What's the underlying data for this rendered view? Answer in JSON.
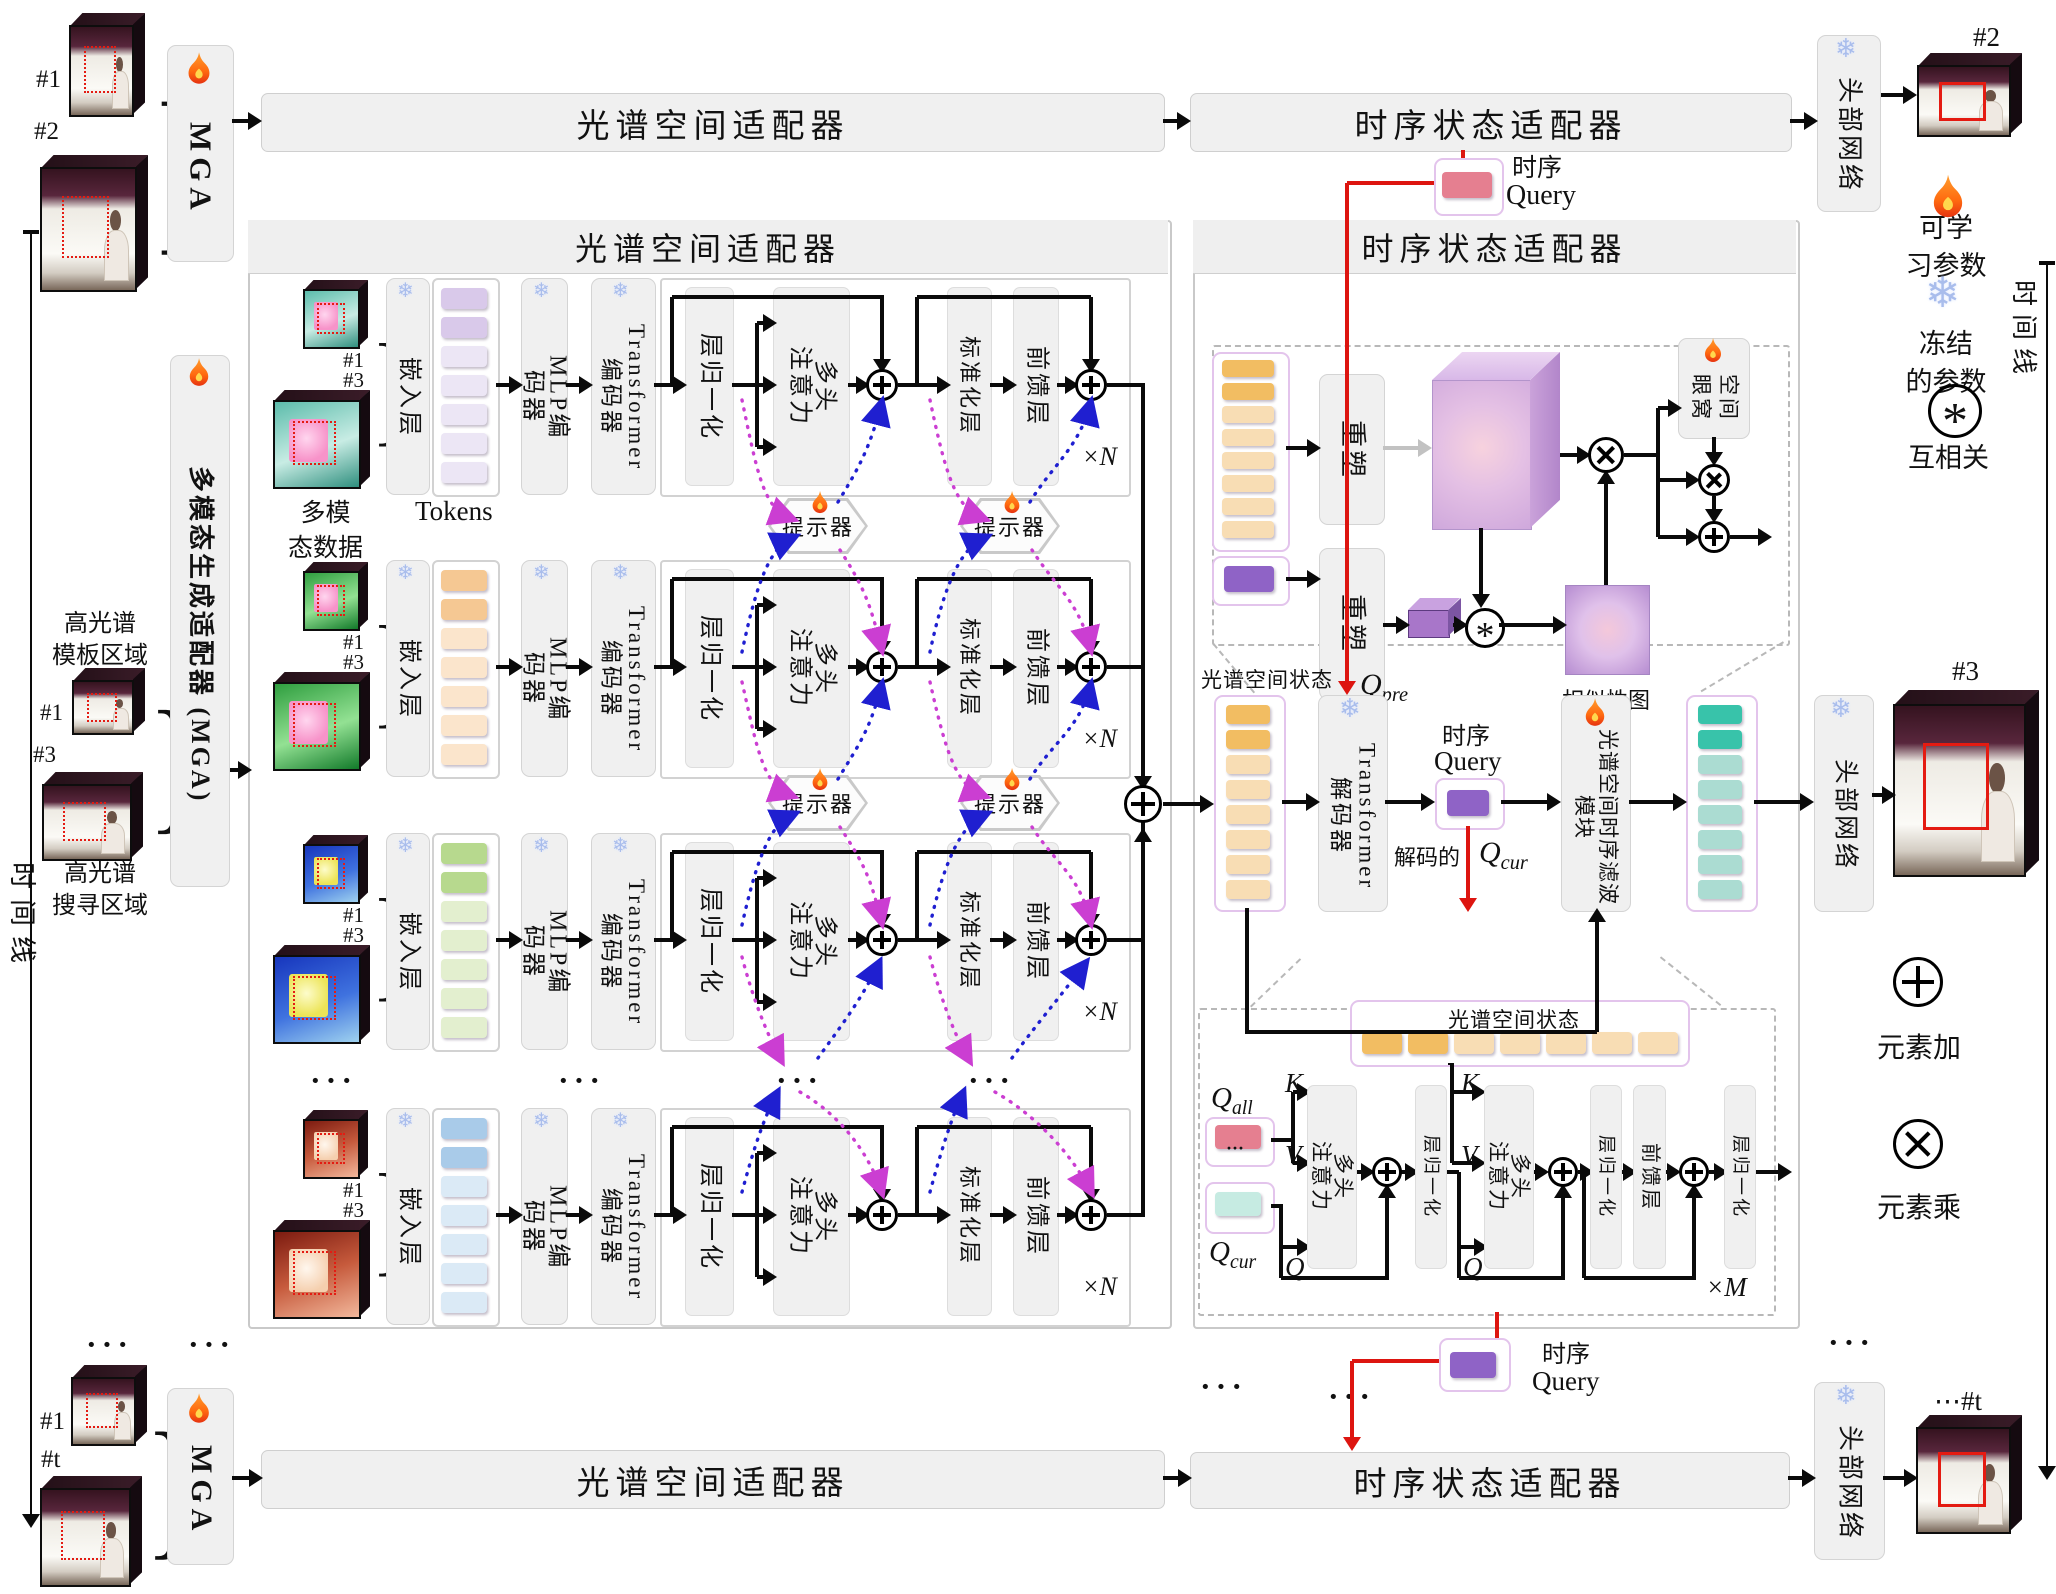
{
  "colors": {
    "accent_red": "#dd1510",
    "magenta_prompt": "#cb3ed2",
    "blue_prompt": "#1f1fd0",
    "orange_dark": "#f2bd62",
    "orange_light": "#f8ddb4",
    "teal_dark": "#38c3aa",
    "teal_light": "#abdcd2",
    "purple_token": "#8f63c6",
    "pink_token": "#e57f90",
    "pale_teal_token": "#c6ebe2",
    "lavender_border": "#e3c4ec",
    "snow_blue": "#a9bdec",
    "fire_orange": "#ff7a1a"
  },
  "titles": {
    "spectral_adapter": "光谱空间适配器",
    "temporal_adapter": "时序状态适配器",
    "head_network": "头部网络",
    "mga_short": "MGA",
    "mga_full": "多模态生成适配器 (MGA)"
  },
  "frames": {
    "f1": "#1",
    "f2": "#2",
    "f3": "#3",
    "ft": "#t",
    "ft_dots": "⋯#t"
  },
  "left_labels": {
    "timeline": "时间线",
    "template_region_l1": "高光谱",
    "template_region_l2": "模板区域",
    "search_region_l1": "高光谱",
    "search_region_l2": "搜寻区域",
    "multimodal_l1": "多模",
    "multimodal_l2": "态数据",
    "tokens": "Tokens"
  },
  "encoder": {
    "embed": "嵌入层",
    "mlp_l1": "MLP编",
    "mlp_l2": "码器",
    "enc_l1": "Transformer",
    "enc_l2": "编码器",
    "layer_norm": "层归一化",
    "mha_l1": "多头",
    "mha_l2": "注意力",
    "norm_layer": "标准化层",
    "ffn": "前馈层",
    "xn": "×N",
    "prompter": "提示器",
    "dots": "···"
  },
  "rows": [
    {
      "name": "modality-1",
      "tok_dark": "#d9c9ea",
      "tok_light": "#ece6f5"
    },
    {
      "name": "modality-2",
      "tok_dark": "#f5c893",
      "tok_light": "#fbe5cc"
    },
    {
      "name": "modality-3",
      "tok_dark": "#b7d98e",
      "tok_light": "#e3efcf"
    },
    {
      "name": "modality-4",
      "tok_dark": "#a9cbe9",
      "tok_light": "#dbeaf6"
    }
  ],
  "temporal": {
    "query_cn": "时序",
    "query_en": "Query",
    "reshape": "重塑",
    "similarity_map": "相似性图",
    "spatial_l1": "空间",
    "spatial_l2": "眼窝",
    "state": "光谱空间状态",
    "decoder_l1": "Transformer",
    "decoder_l2": "解码器",
    "decoded": "解码的",
    "filter_module": "光谱空间时序滤波模块",
    "q": "Q",
    "sub_pre": "pre",
    "sub_cur": "cur",
    "sub_all": "all",
    "k": "K",
    "v": "V",
    "xm": "×M",
    "star": "*"
  },
  "legend": {
    "learnable_l1": "可学",
    "learnable_l2": "习参数",
    "frozen_l1": "冻结",
    "frozen_l2": "的参数",
    "xcorr": "互相关",
    "add": "元素加",
    "mul": "元素乘",
    "timeline": "时间线"
  }
}
